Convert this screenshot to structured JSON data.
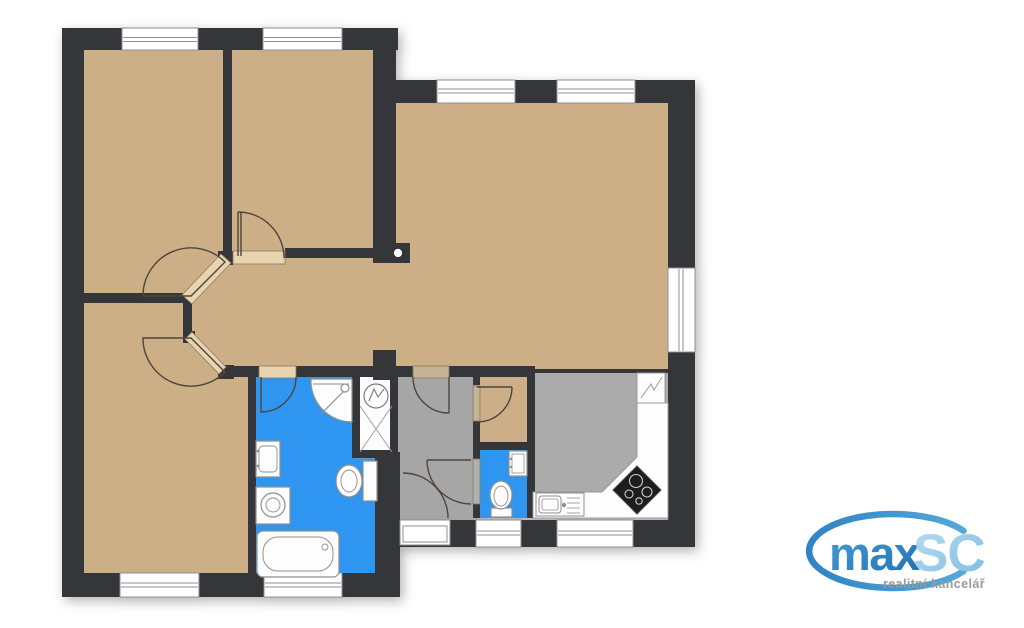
{
  "logo": {
    "brand_primary": "max",
    "brand_secondary": "SC",
    "tagline": "realitní kancelář"
  },
  "palette": {
    "wall": "#35363a",
    "floor_tan": "#ccae87",
    "floor_gray_corridor": "#a6a6a6",
    "floor_gray_kitchen": "#ababab",
    "wet_room_blue": "#2e96f0",
    "fixture_fill": "#fdfdfd",
    "fixture_stroke": "#8f8f8f",
    "door_arc": "#4e4639",
    "door_sill": "#e9d4b0",
    "logo_primary_blue": "#2f86c6",
    "logo_secondary_blue": "#9ccfec",
    "logo_tagline_gray": "#9a9a9a"
  },
  "floorplan": {
    "type": "residential floor plan, top-down",
    "rooms": [
      {
        "id": "room-top-left",
        "floor": "tan",
        "windows": 1,
        "doors": [
          "diagonal door to hallway"
        ]
      },
      {
        "id": "room-top-middle",
        "floor": "tan",
        "windows": 1,
        "doors": [
          "door to hallway"
        ]
      },
      {
        "id": "living-room",
        "floor": "tan",
        "windows": 3,
        "doors": [
          "open to hallway",
          "open to kitchen"
        ]
      },
      {
        "id": "room-bottom-left",
        "floor": "tan",
        "windows": 1,
        "doors": [
          "diagonal door to hallway"
        ]
      },
      {
        "id": "hallway",
        "floor": "tan",
        "windows": 0
      },
      {
        "id": "bathroom",
        "floor": "blue",
        "windows": 1,
        "fixtures": [
          "corner shower",
          "washbasin",
          "washing machine",
          "toilet",
          "bathtub"
        ]
      },
      {
        "id": "utility-closet",
        "floor": "white",
        "fixtures": [
          "water heater"
        ]
      },
      {
        "id": "corridor",
        "floor": "gray",
        "doors": [
          "hallway door",
          "pantry door",
          "wc door",
          "entrance door"
        ]
      },
      {
        "id": "pantry",
        "floor": "tan",
        "windows": 0
      },
      {
        "id": "wc",
        "floor": "blue",
        "windows": 1,
        "fixtures": [
          "toilet",
          "small washbasin"
        ]
      },
      {
        "id": "kitchen",
        "floor": "gray",
        "windows": 1,
        "fixtures": [
          "refrigerator",
          "counter",
          "kitchen sink",
          "cooktop"
        ]
      }
    ],
    "window_count": 9,
    "entrance": "bottom of corridor"
  }
}
